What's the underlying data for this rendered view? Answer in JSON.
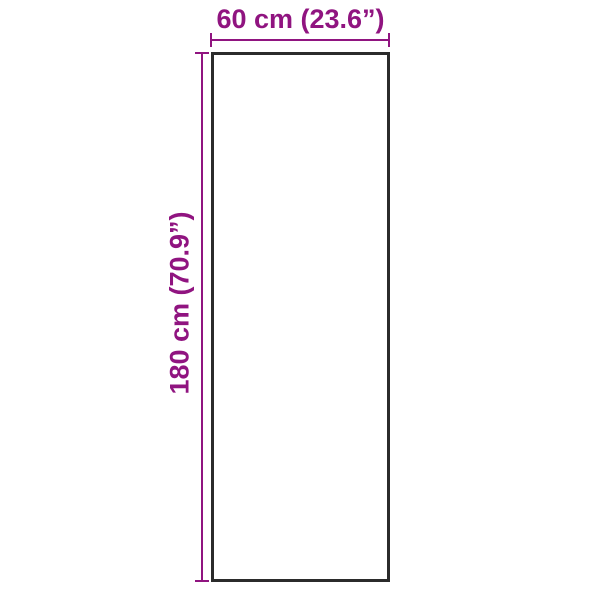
{
  "diagram": {
    "width_label": "60 cm (23.6”)",
    "height_label": "180 cm (70.9”)",
    "colors": {
      "accent": "#901480",
      "outline": "#2b2b2b",
      "background": "#ffffff"
    }
  }
}
